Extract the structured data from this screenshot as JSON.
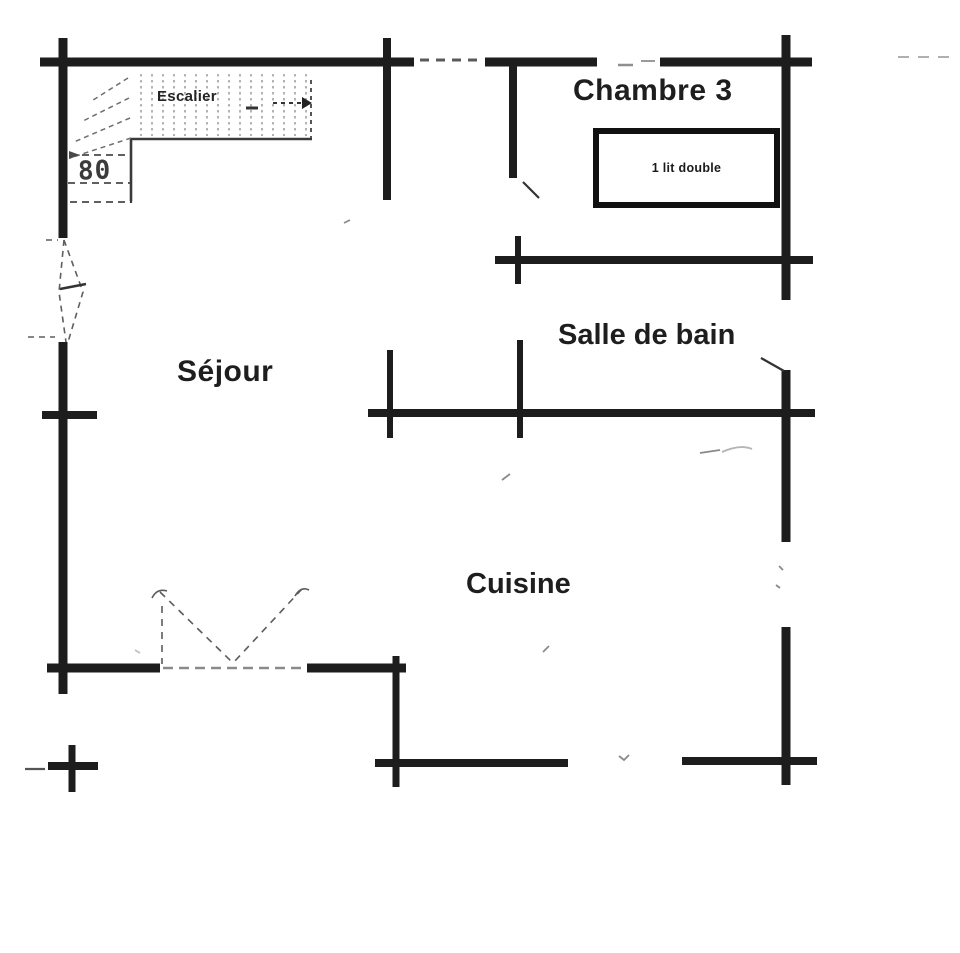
{
  "plan": {
    "type": "floor-plan",
    "language": "fr",
    "rooms": {
      "escalier": {
        "label": "Escalier"
      },
      "chambre3": {
        "label": "Chambre 3"
      },
      "salle_de_bain": {
        "label": "Salle de bain"
      },
      "sejour": {
        "label": "Séjour"
      },
      "cuisine": {
        "label": "Cuisine"
      }
    },
    "furniture": {
      "bed": {
        "label": "1 lit double"
      }
    },
    "dimensions": {
      "stair_width": {
        "label": "80"
      }
    },
    "colors": {
      "wall": "#1d1d1d",
      "wall_thin": "#333333",
      "faint": "#8a8a8a",
      "text": "#1e1e1e",
      "background": "#ffffff"
    }
  }
}
